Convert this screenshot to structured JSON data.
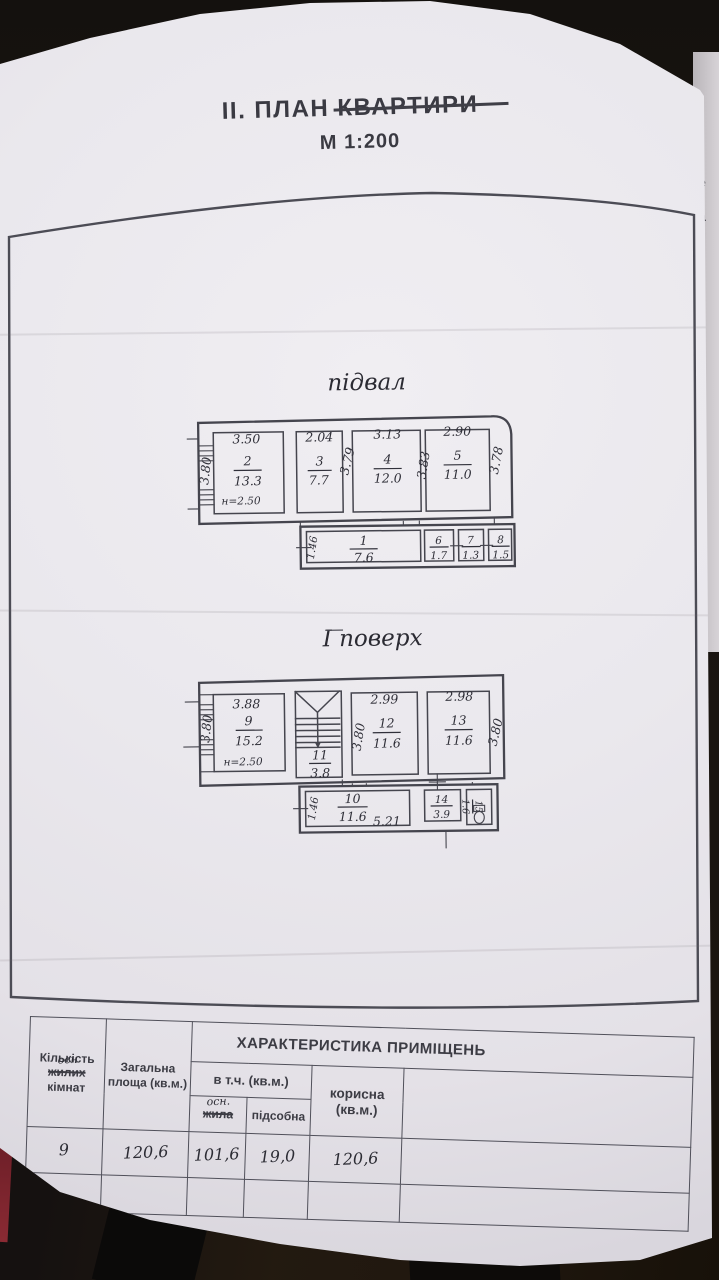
{
  "photo": {
    "neighbor_page_fragments": {
      "frag1": "е",
      "frag2": "а"
    }
  },
  "header": {
    "title_prefix": "ІІ. ПЛАН",
    "title_struck": "КВАРТИРИ",
    "scale": "М 1:200"
  },
  "basement": {
    "label": "підвал",
    "room1": {
      "n": "1",
      "a": "7.6",
      "side": "1.46"
    },
    "room2": {
      "n": "2",
      "a": "13.3",
      "top": "3.50",
      "side": "3.80",
      "note": "н=2.50"
    },
    "room3": {
      "n": "3",
      "a": "7.7",
      "top": "2.04",
      "side": "3.79"
    },
    "room4": {
      "n": "4",
      "a": "12.0",
      "top": "3.13",
      "side": "3.83"
    },
    "room5": {
      "n": "5",
      "a": "11.0",
      "top": "2.90",
      "side": "3.78"
    },
    "room6": {
      "n": "6",
      "a": "1.7"
    },
    "room7": {
      "n": "7",
      "a": "1.3"
    },
    "room8": {
      "n": "8",
      "a": "1.5"
    }
  },
  "floor1": {
    "label": "І поверх",
    "room9": {
      "n": "9",
      "a": "15.2",
      "top": "3.88",
      "side": "3.80",
      "note": "н=2.50"
    },
    "room10": {
      "n": "10",
      "a": "11.6",
      "side": "1.46",
      "extra": "5.21"
    },
    "room11": {
      "n": "11",
      "a": "3.8"
    },
    "room12": {
      "n": "12",
      "a": "11.6",
      "top": "2.99",
      "side": "3.80"
    },
    "room13": {
      "n": "13",
      "a": "11.6",
      "top": "2.98",
      "side": "3.80"
    },
    "room14": {
      "n": "14",
      "a": "3.9"
    },
    "room15": {
      "n": "15",
      "a": "1.6"
    }
  },
  "table": {
    "banner": "ХАРАКТЕРИСТИКА ПРИМІЩЕНЬ",
    "col1_line1": "Кількість",
    "col1_struck": "жилих",
    "col1_hand": "осн",
    "col1_line2": "кімнат",
    "col2": "Загальна площа (кв.м.)",
    "group_incl": "в т.ч. (кв.м.)",
    "col3_hand": "осн.",
    "col3_struck": "жила",
    "col4": "підсобна",
    "col5": "корисна (кв.м.)",
    "values": {
      "count": "9",
      "total": "120,6",
      "living": "101,6",
      "aux": "19,0",
      "useful": "120,6"
    }
  }
}
